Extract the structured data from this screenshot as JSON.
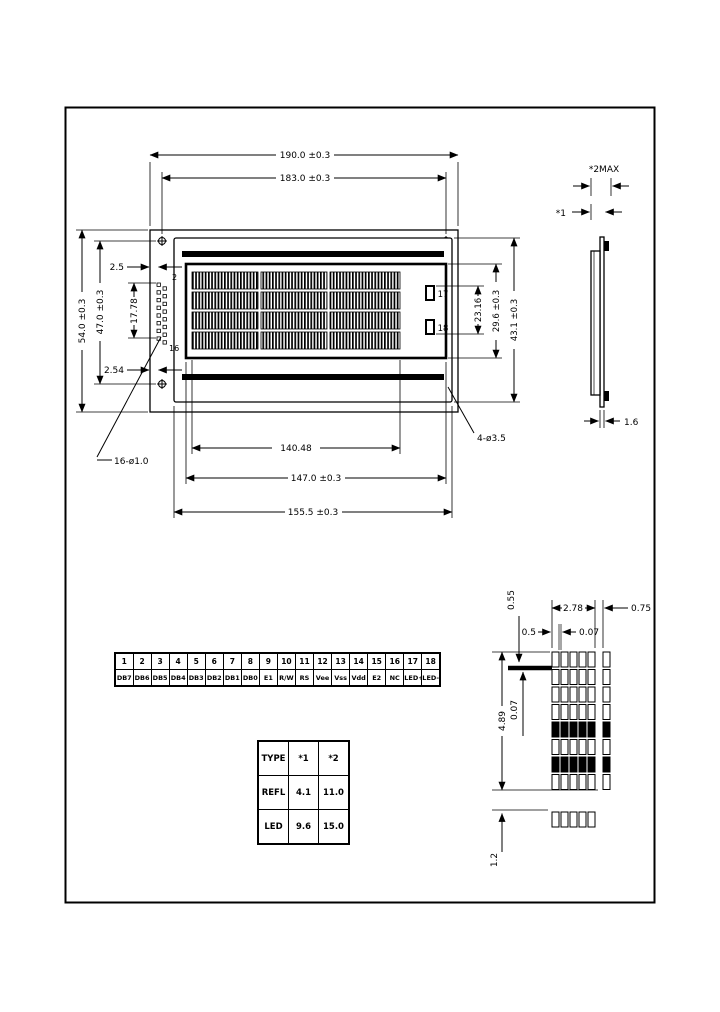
{
  "front_view": {
    "dims": {
      "width_outer": "190.0 ±0.3",
      "width_holes": "183.0 ±0.3",
      "height_outer": "54.0 ±0.3",
      "height_holes": "47.0 ±0.3",
      "connector_span": "17.78",
      "edge_gap": "2.5",
      "pin_pitch": "2.54",
      "pin_first": "2",
      "pin_last": "16",
      "pad_top": "17",
      "pad_bottom": "18",
      "pad_span": "23.16",
      "va_height": "29.6 ±0.3",
      "bezel_height": "43.1 ±0.3",
      "char_area_width": "140.48",
      "va_width": "147.0 ±0.3",
      "bezel_width": "155.5 ±0.3",
      "mount_holes_label": "4-ø3.5",
      "pin_holes_label": "16-ø1.0"
    }
  },
  "side_view": {
    "max_thickness": "*2MAX",
    "thickness_1": "*1",
    "pcb_thickness": "1.6"
  },
  "pin_table": {
    "numbers": [
      "1",
      "2",
      "3",
      "4",
      "5",
      "6",
      "7",
      "8",
      "9",
      "10",
      "11",
      "12",
      "13",
      "14",
      "15",
      "16",
      "17",
      "18"
    ],
    "names": [
      "DB7",
      "DB6",
      "DB5",
      "DB4",
      "DB3",
      "DB2",
      "DB1",
      "DB0",
      "E1",
      "R/W",
      "RS",
      "Vee",
      "Vss",
      "Vdd",
      "E2",
      "NC",
      "LED+",
      "LED-"
    ]
  },
  "type_table": {
    "headers": [
      "TYPE",
      "*1",
      "*2"
    ],
    "rows": [
      [
        "REFL",
        "4.1",
        "11.0"
      ],
      [
        "LED",
        "9.6",
        "15.0"
      ]
    ]
  },
  "char_detail": {
    "dot_height": "0.55",
    "char_width": "2.78",
    "char_gap": "0.75",
    "dot_width": "0.5",
    "dot_gap_h": "0.07",
    "char_height": "4.89",
    "dot_gap_v": "0.07",
    "line_gap": "1.2"
  }
}
